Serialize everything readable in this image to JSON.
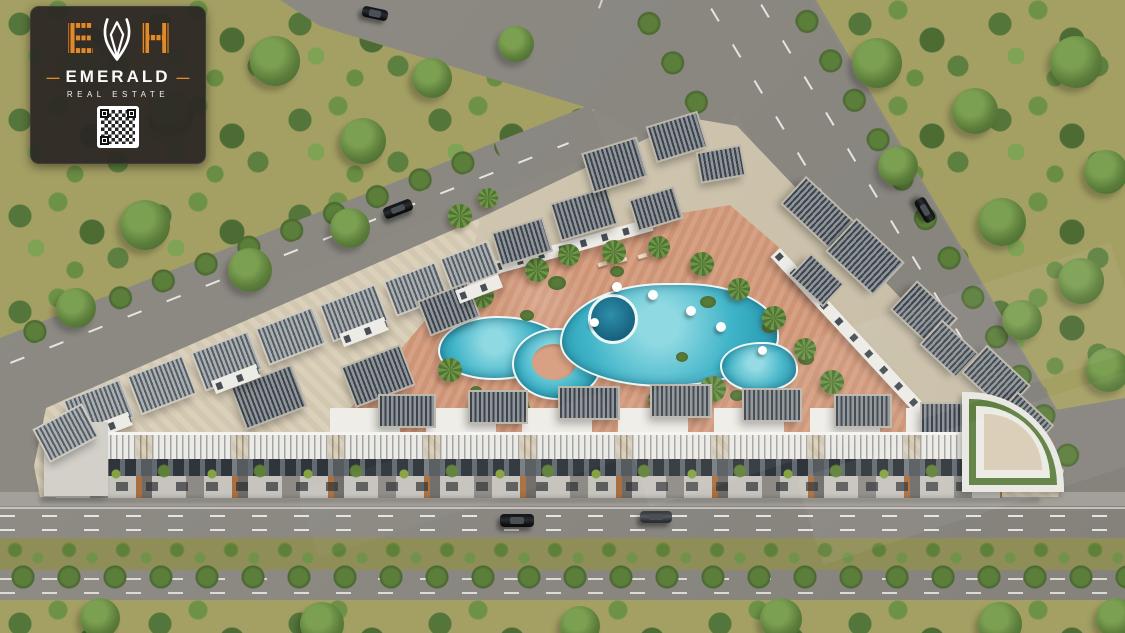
{
  "scene": {
    "label": "aerial-render-residential-compound"
  },
  "logo_card": {
    "monogram_left": "E",
    "monogram_right": "H",
    "gem_icon": "gem-outline-icon",
    "brand": "EMERALD",
    "subtitle": "REAL ESTATE",
    "dash_left": "—",
    "dash_right": "—",
    "qr_icon": "qr-code"
  },
  "palette": {
    "accent_orange": "#E08A2E",
    "card_background": "#2C2724",
    "pool_turquoise": "#3FB4C8",
    "pool_deep": "#1D6F8C",
    "paving_beige": "#D9CDB6",
    "courtyard_terracotta": "#D39A7C",
    "asphalt_gray": "#8C8983",
    "vegetation_green": "#5C7E3B",
    "ground_olive": "#A49F63",
    "pergola_slat": "#3C444B",
    "building_white": "#ECEAE5"
  }
}
